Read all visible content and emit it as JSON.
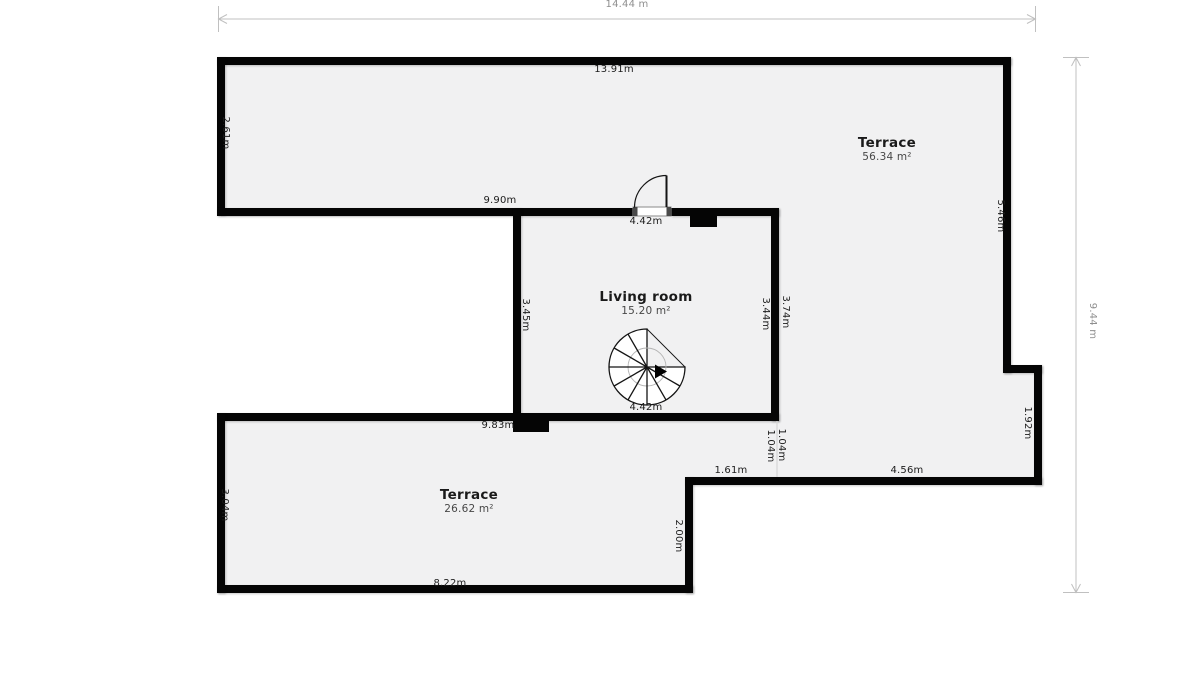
{
  "plan": {
    "rooms": [
      {
        "name": "Terrace",
        "area": "56.34 m²"
      },
      {
        "name": "Living room",
        "area": "15.20 m²"
      },
      {
        "name": "Terrace",
        "area": "26.62 m²"
      }
    ],
    "overall": {
      "width": "14.44 m",
      "height": "9.44 m"
    },
    "dims": {
      "top_wall": "13.91m",
      "upper_left": "2.61m",
      "mid_wall": "9.90m",
      "door_width": "4.42m",
      "upper_right": "5.46m",
      "living_left": "3.45m",
      "living_right_inner": "3.44m",
      "living_right_outer": "3.74m",
      "living_bottom": "4.42m",
      "lower_mid_wall": "9.83m",
      "seg_inner": "1.04m",
      "seg_outer": "1.04m",
      "step_left": "1.61m",
      "step_right": "4.56m",
      "right_step": "1.92m",
      "lower_inner": "2.00m",
      "lower_left": "3.04m",
      "bottom_wall": "8.22m"
    },
    "icons": [
      "door-swing-icon",
      "spiral-stairs-icon",
      "direction-arrow-icon",
      "dimension-arrow-icon"
    ],
    "colors": {
      "wall": "#050505",
      "floor": "#f1f1f2",
      "background": "#ffffff",
      "dim_line": "#c0c0c0",
      "dim_text_outer": "#8f8f8f",
      "dim_text_wall": "#1c1c1c",
      "room_name": "#1a1a1a",
      "room_area": "#474747"
    }
  }
}
